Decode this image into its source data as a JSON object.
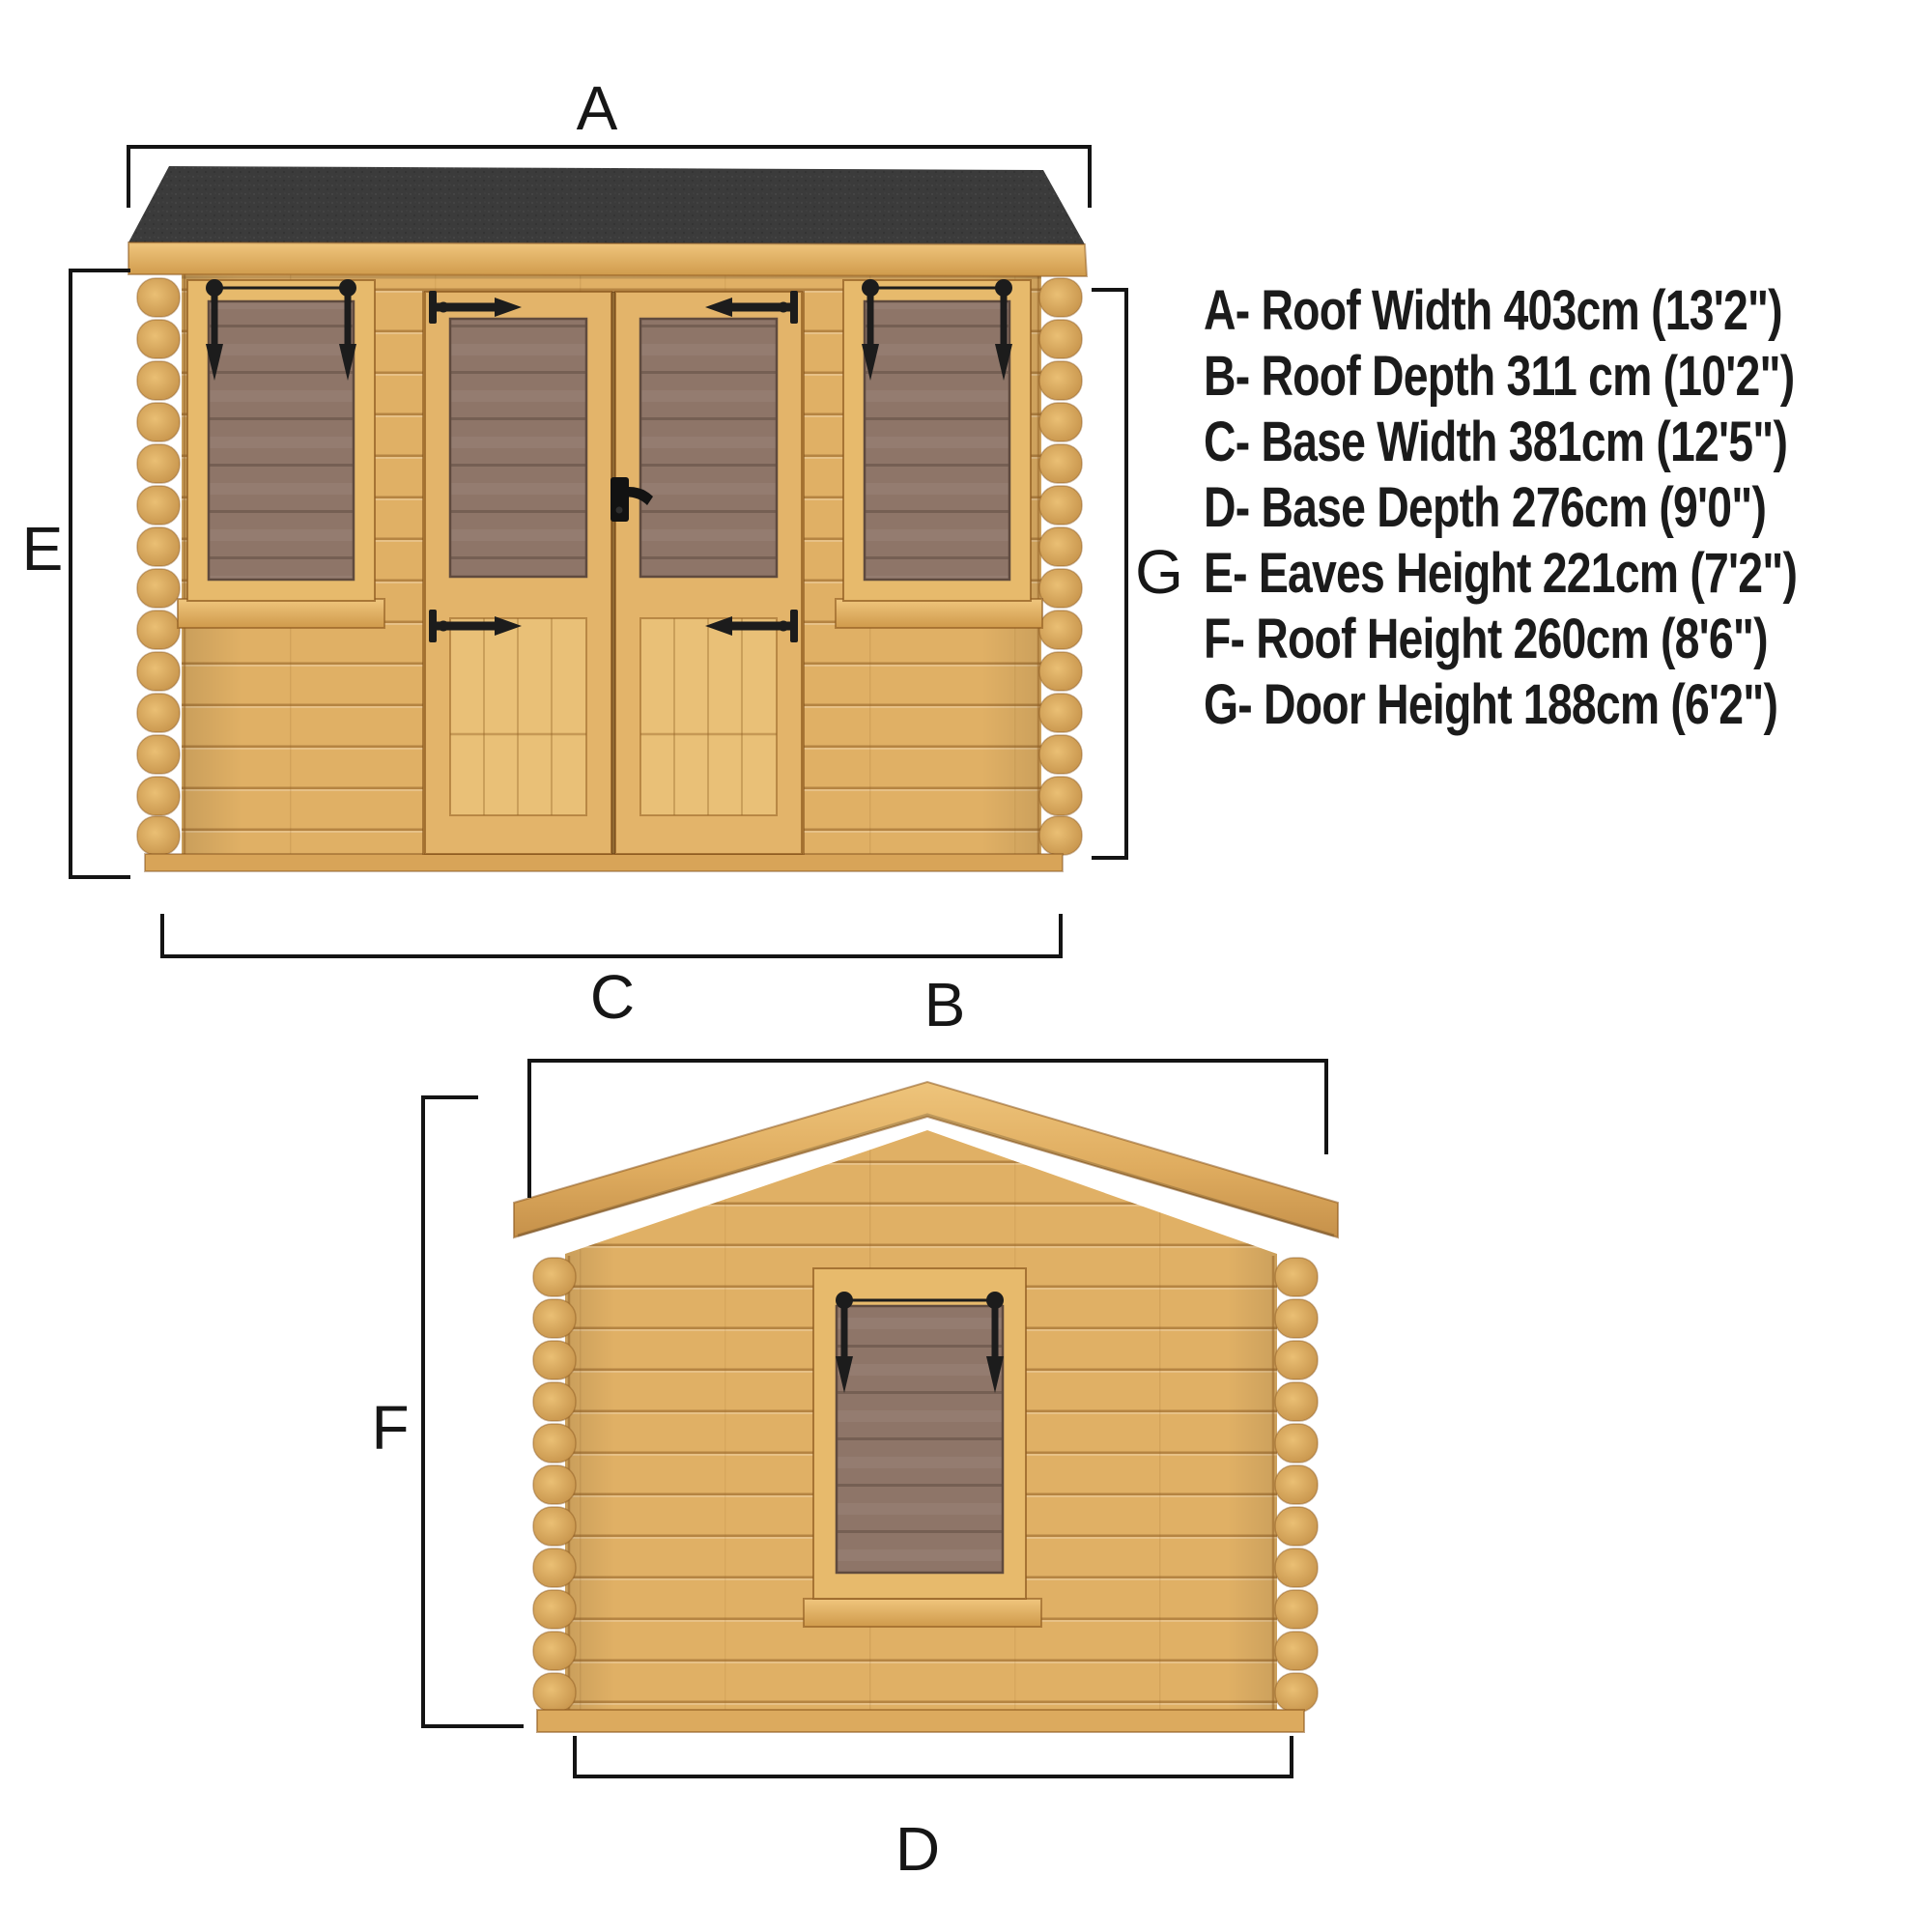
{
  "page": {
    "background": "#ffffff",
    "description_visible_views": [
      "front elevation with flat felt roof",
      "side elevation with apex roof"
    ]
  },
  "front_view": {
    "dimension_labels": {
      "roof_width": "A",
      "base_width": "C",
      "eaves_height": "E",
      "door_height": "G"
    }
  },
  "side_view": {
    "dimension_labels": {
      "roof_depth": "B",
      "base_depth": "D",
      "roof_height": "F"
    }
  },
  "legend": {
    "items": [
      {
        "code": "A",
        "name": "Roof Width",
        "metric": "403cm",
        "imperial": "13'2\"",
        "text": "A- Roof Width 403cm (13'2\")"
      },
      {
        "code": "B",
        "name": "Roof Depth",
        "metric": "311 cm",
        "imperial": "10'2\"",
        "text": "B- Roof Depth 311 cm (10'2\")"
      },
      {
        "code": "C",
        "name": "Base Width",
        "metric": "381cm",
        "imperial": "12'5\"",
        "text": "C- Base Width 381cm (12'5\")"
      },
      {
        "code": "D",
        "name": "Base Depth",
        "metric": "276cm",
        "imperial": "9'0\"",
        "text": "D- Base Depth 276cm (9'0\")"
      },
      {
        "code": "E",
        "name": "Eaves Height",
        "metric": "221cm",
        "imperial": "7'2\"",
        "text": "E- Eaves Height 221cm (7'2\")"
      },
      {
        "code": "F",
        "name": "Roof Height",
        "metric": "260cm",
        "imperial": "8'6\"",
        "text": "F- Roof Height 260cm (8'6\")"
      },
      {
        "code": "G",
        "name": "Door Height",
        "metric": "188cm",
        "imperial": "6'2\"",
        "text": "G- Door Height 188cm (6'2\")"
      }
    ]
  },
  "colors": {
    "roof_felt": "#3b3b3b",
    "wood_light": "#e0b065",
    "wood_dark": "#c08b43",
    "glass": "#8e7568",
    "ironmongery": "#1c1c1c",
    "dimension_line": "#141414"
  }
}
